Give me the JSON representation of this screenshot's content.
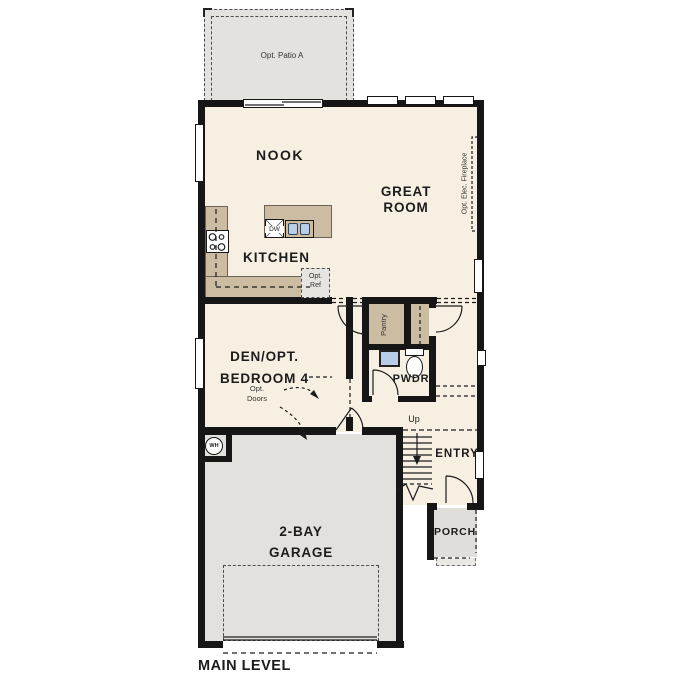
{
  "plan_title": "MAIN LEVEL",
  "rooms": {
    "nook": {
      "label": "NOOK"
    },
    "great_room": {
      "line1": "GREAT",
      "line2": "ROOM"
    },
    "kitchen": {
      "label": "KITCHEN"
    },
    "den": {
      "line1": "DEN/OPT.",
      "line2": "BEDROOM 4"
    },
    "pwdr": {
      "label": "PWDR"
    },
    "entry": {
      "label": "ENTRY"
    },
    "porch": {
      "label": "PORCH"
    },
    "garage": {
      "line1": "2-BAY",
      "line2": "GARAGE"
    },
    "pantry": {
      "label": "Pantry"
    }
  },
  "options": {
    "patio": {
      "label": "Opt. Patio A"
    },
    "fireplace": {
      "label": "Opt. Elec. Fireplace"
    },
    "refrigerator": {
      "line1": "Opt.",
      "line2": "Ref"
    },
    "doors": {
      "line1": "Opt.",
      "line2": "Doors"
    }
  },
  "fixtures": {
    "dishwasher": {
      "label": "DW"
    },
    "water_heater": {
      "label": "WH"
    },
    "stairs": {
      "label": "Up"
    }
  },
  "colors": {
    "wall": "#161616",
    "floor": "#f7f0e2",
    "casework_tan": "#cbbca2",
    "exterior_gray": "#e2e1de",
    "fixture_blue": "#b7cde8",
    "dashed_line": "#4a4a4a"
  }
}
